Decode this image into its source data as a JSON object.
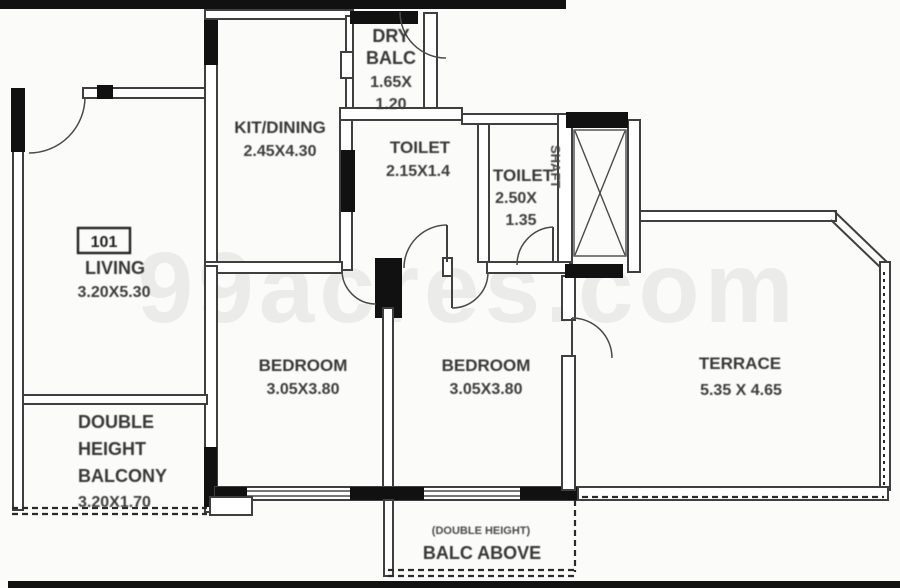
{
  "watermark": "99acres.com",
  "unit": {
    "number": "101"
  },
  "rooms": {
    "dry_balc": {
      "l1": "DRY",
      "l2": "BALC",
      "l3": "1.65X",
      "l4": "1.20"
    },
    "kit_dining": {
      "name": "KIT/DINING",
      "dim": "2.45X4.30"
    },
    "toilet_1": {
      "name": "TOILET",
      "dim": "2.15X1.4"
    },
    "toilet_2": {
      "name": "TOILET",
      "dim1": "2.50X",
      "dim2": "1.35"
    },
    "shaft": {
      "name": "SHAFT"
    },
    "living": {
      "name": "LIVING",
      "dim": "3.20X5.30"
    },
    "bedroom_1": {
      "name": "BEDROOM",
      "dim": "3.05X3.80"
    },
    "bedroom_2": {
      "name": "BEDROOM",
      "dim": "3.05X3.80"
    },
    "terrace": {
      "name": "TERRACE",
      "dim": "5.35 X 4.65"
    },
    "double_height_balcony": {
      "l1": "DOUBLE",
      "l2": "HEIGHT",
      "l3": "BALCONY",
      "l4": "3.20X1.70"
    },
    "balc_above": {
      "note": "(DOUBLE HEIGHT)",
      "name": "BALC ABOVE"
    }
  },
  "colors": {
    "wall_line": "#3f3f3f",
    "column": "#111111",
    "label_text": "#383838",
    "background": "#fbfbf9",
    "watermark_gray": "rgba(50,50,50,0.08)"
  }
}
